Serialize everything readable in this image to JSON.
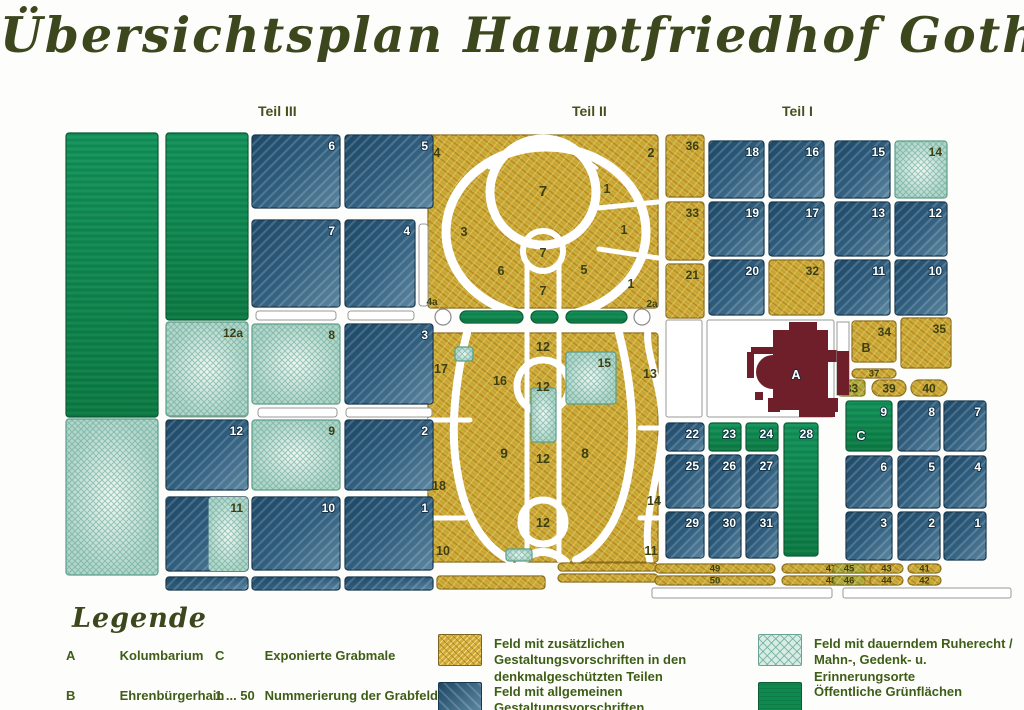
{
  "title": "Übersichtsplan Hauptfriedhof Gotha",
  "sections": [
    {
      "label": "Teil III"
    },
    {
      "label": "Teil II"
    },
    {
      "label": "Teil I"
    }
  ],
  "colors": {
    "gold": "#d3ac37",
    "blue": "#2e5a7b",
    "teal": "#cde7df",
    "green": "#0f8a4e",
    "building": "#6e1f2a",
    "text_olive": "#3e5d16"
  },
  "map": {
    "building_label": "A",
    "panels": [
      {
        "x": 428,
        "y": 135,
        "w": 230,
        "h": 173,
        "c": "gold"
      },
      {
        "x": 428,
        "y": 333,
        "w": 230,
        "h": 229,
        "c": "gold"
      }
    ],
    "fields": [
      {
        "x": 66,
        "y": 133,
        "w": 92,
        "h": 284,
        "c": "green"
      },
      {
        "x": 66,
        "y": 419,
        "w": 92,
        "h": 156,
        "c": "teal"
      },
      {
        "x": 166,
        "y": 133,
        "w": 82,
        "h": 187,
        "c": "green"
      },
      {
        "label": "12a",
        "x": 166,
        "y": 322,
        "w": 82,
        "h": 94,
        "c": "teal"
      },
      {
        "label": "12",
        "x": 166,
        "y": 420,
        "w": 82,
        "h": 70,
        "c": "blue"
      },
      {
        "label": "11",
        "x": 166,
        "y": 497,
        "w": 82,
        "h": 74,
        "c": "split"
      },
      {
        "x": 166,
        "y": 577,
        "w": 82,
        "h": 13,
        "c": "blue"
      },
      {
        "label": "6",
        "x": 252,
        "y": 135,
        "w": 88,
        "h": 73,
        "c": "blue"
      },
      {
        "label": "7",
        "x": 252,
        "y": 220,
        "w": 88,
        "h": 87,
        "c": "blue"
      },
      {
        "label": "8",
        "x": 252,
        "y": 324,
        "w": 88,
        "h": 80,
        "c": "teal"
      },
      {
        "label": "9",
        "x": 252,
        "y": 420,
        "w": 88,
        "h": 70,
        "c": "teal"
      },
      {
        "label": "10",
        "x": 252,
        "y": 497,
        "w": 88,
        "h": 73,
        "c": "blue"
      },
      {
        "x": 252,
        "y": 577,
        "w": 88,
        "h": 13,
        "c": "blue"
      },
      {
        "label": "5",
        "x": 345,
        "y": 135,
        "w": 88,
        "h": 73,
        "c": "blue"
      },
      {
        "label": "4",
        "x": 345,
        "y": 220,
        "w": 70,
        "h": 87,
        "c": "blue"
      },
      {
        "label": "3",
        "x": 345,
        "y": 324,
        "w": 88,
        "h": 80,
        "c": "blue"
      },
      {
        "label": "2",
        "x": 345,
        "y": 420,
        "w": 88,
        "h": 70,
        "c": "blue"
      },
      {
        "label": "1",
        "x": 345,
        "y": 497,
        "w": 88,
        "h": 73,
        "c": "blue"
      },
      {
        "x": 345,
        "y": 577,
        "w": 88,
        "h": 13,
        "c": "blue"
      },
      {
        "label": "15",
        "x": 566,
        "y": 352,
        "w": 50,
        "h": 52,
        "c": "teal"
      },
      {
        "x": 531,
        "y": 388,
        "w": 25,
        "h": 54,
        "c": "teal"
      },
      {
        "x": 455,
        "y": 347,
        "w": 18,
        "h": 14,
        "c": "teal"
      },
      {
        "x": 506,
        "y": 549,
        "w": 26,
        "h": 12,
        "c": "teal"
      },
      {
        "x": 460,
        "y": 311,
        "w": 63,
        "h": 12,
        "c": "green",
        "s": "pill"
      },
      {
        "x": 531,
        "y": 311,
        "w": 27,
        "h": 12,
        "c": "green",
        "s": "pill"
      },
      {
        "x": 566,
        "y": 311,
        "w": 61,
        "h": 12,
        "c": "green",
        "s": "pill"
      },
      {
        "x": 443,
        "y": 317,
        "w": 8,
        "c": "white",
        "s": "circle"
      },
      {
        "x": 642,
        "y": 317,
        "w": 8,
        "c": "white",
        "s": "circle"
      },
      {
        "x": 437,
        "y": 576,
        "w": 108,
        "h": 13,
        "c": "gold"
      },
      {
        "x": 558,
        "y": 563,
        "w": 100,
        "h": 8,
        "c": "gold",
        "s": "pill"
      },
      {
        "x": 558,
        "y": 574,
        "w": 100,
        "h": 8,
        "c": "gold",
        "s": "pill"
      },
      {
        "label": "36",
        "x": 666,
        "y": 135,
        "w": 38,
        "h": 62,
        "c": "gold"
      },
      {
        "label": "33",
        "x": 666,
        "y": 202,
        "w": 38,
        "h": 58,
        "c": "gold"
      },
      {
        "label": "21",
        "x": 666,
        "y": 264,
        "w": 38,
        "h": 54,
        "c": "gold"
      },
      {
        "label": "18",
        "x": 709,
        "y": 141,
        "w": 55,
        "h": 57,
        "c": "blue"
      },
      {
        "label": "16",
        "x": 769,
        "y": 141,
        "w": 55,
        "h": 57,
        "c": "blue"
      },
      {
        "label": "19",
        "x": 709,
        "y": 202,
        "w": 55,
        "h": 54,
        "c": "blue"
      },
      {
        "label": "17",
        "x": 769,
        "y": 202,
        "w": 55,
        "h": 54,
        "c": "blue"
      },
      {
        "label": "20",
        "x": 709,
        "y": 260,
        "w": 55,
        "h": 55,
        "c": "blue"
      },
      {
        "label": "32",
        "x": 769,
        "y": 260,
        "w": 55,
        "h": 55,
        "c": "gold"
      },
      {
        "label": "15",
        "x": 835,
        "y": 141,
        "w": 55,
        "h": 57,
        "c": "blue"
      },
      {
        "label": "14",
        "x": 895,
        "y": 141,
        "w": 52,
        "h": 57,
        "c": "teal"
      },
      {
        "label": "13",
        "x": 835,
        "y": 202,
        "w": 55,
        "h": 54,
        "c": "blue"
      },
      {
        "label": "12",
        "x": 895,
        "y": 202,
        "w": 52,
        "h": 54,
        "c": "blue"
      },
      {
        "label": "11",
        "x": 835,
        "y": 260,
        "w": 55,
        "h": 55,
        "c": "blue"
      },
      {
        "label": "10",
        "x": 895,
        "y": 260,
        "w": 52,
        "h": 55,
        "c": "blue"
      },
      {
        "label": "34",
        "x": 852,
        "y": 321,
        "w": 44,
        "h": 41,
        "c": "gold"
      },
      {
        "label": "35",
        "x": 901,
        "y": 318,
        "w": 50,
        "h": 50,
        "c": "gold"
      },
      {
        "label": "37",
        "x": 852,
        "y": 369,
        "w": 44,
        "h": 9,
        "c": "gold",
        "s": "pill",
        "lp": "c"
      },
      {
        "label": "33",
        "x": 838,
        "y": 380,
        "w": 27,
        "h": 16,
        "c": "goldgreen",
        "lp": "c"
      },
      {
        "label": "39",
        "x": 872,
        "y": 380,
        "w": 34,
        "h": 16,
        "c": "gold",
        "s": "pill",
        "lp": "c"
      },
      {
        "label": "40",
        "x": 911,
        "y": 380,
        "w": 36,
        "h": 16,
        "c": "gold",
        "s": "pill",
        "lp": "c"
      },
      {
        "label": "9",
        "x": 846,
        "y": 401,
        "w": 46,
        "h": 50,
        "c": "green"
      },
      {
        "label": "8",
        "x": 898,
        "y": 401,
        "w": 42,
        "h": 50,
        "c": "blue"
      },
      {
        "label": "7",
        "x": 944,
        "y": 401,
        "w": 42,
        "h": 50,
        "c": "blue"
      },
      {
        "label": "6",
        "x": 846,
        "y": 456,
        "w": 46,
        "h": 52,
        "c": "blue"
      },
      {
        "label": "5",
        "x": 898,
        "y": 456,
        "w": 42,
        "h": 52,
        "c": "blue"
      },
      {
        "label": "4",
        "x": 944,
        "y": 456,
        "w": 42,
        "h": 52,
        "c": "blue"
      },
      {
        "label": "3",
        "x": 846,
        "y": 512,
        "w": 46,
        "h": 48,
        "c": "blue"
      },
      {
        "label": "2",
        "x": 898,
        "y": 512,
        "w": 42,
        "h": 48,
        "c": "blue"
      },
      {
        "label": "1",
        "x": 944,
        "y": 512,
        "w": 42,
        "h": 48,
        "c": "blue"
      },
      {
        "label": "22",
        "x": 666,
        "y": 423,
        "w": 38,
        "h": 28,
        "c": "blue"
      },
      {
        "label": "23",
        "x": 709,
        "y": 423,
        "w": 32,
        "h": 28,
        "c": "green"
      },
      {
        "label": "24",
        "x": 746,
        "y": 423,
        "w": 32,
        "h": 28,
        "c": "green"
      },
      {
        "label": "28",
        "x": 784,
        "y": 423,
        "w": 34,
        "h": 133,
        "c": "green"
      },
      {
        "label": "25",
        "x": 666,
        "y": 455,
        "w": 38,
        "h": 53,
        "c": "blue"
      },
      {
        "label": "26",
        "x": 709,
        "y": 455,
        "w": 32,
        "h": 53,
        "c": "blue"
      },
      {
        "label": "27",
        "x": 746,
        "y": 455,
        "w": 32,
        "h": 53,
        "c": "blue"
      },
      {
        "label": "29",
        "x": 666,
        "y": 512,
        "w": 38,
        "h": 46,
        "c": "blue"
      },
      {
        "label": "30",
        "x": 709,
        "y": 512,
        "w": 32,
        "h": 46,
        "c": "blue"
      },
      {
        "label": "31",
        "x": 746,
        "y": 512,
        "w": 32,
        "h": 46,
        "c": "blue"
      },
      {
        "label": "49",
        "x": 655,
        "y": 564,
        "w": 120,
        "h": 9,
        "c": "gold",
        "s": "pill",
        "lp": "c"
      },
      {
        "label": "47",
        "x": 782,
        "y": 564,
        "w": 98,
        "h": 9,
        "c": "gold",
        "s": "pill",
        "lp": "c"
      },
      {
        "label": "50",
        "x": 655,
        "y": 576,
        "w": 120,
        "h": 9,
        "c": "gold",
        "s": "pill",
        "lp": "c"
      },
      {
        "label": "48",
        "x": 782,
        "y": 576,
        "w": 98,
        "h": 9,
        "c": "gold",
        "s": "pill",
        "lp": "c"
      },
      {
        "label": "45",
        "x": 833,
        "y": 564,
        "w": 32,
        "h": 9,
        "c": "goldgreen",
        "s": "pill",
        "lp": "c"
      },
      {
        "label": "43",
        "x": 870,
        "y": 564,
        "w": 33,
        "h": 9,
        "c": "gold",
        "s": "pill",
        "lp": "c"
      },
      {
        "label": "41",
        "x": 908,
        "y": 564,
        "w": 33,
        "h": 9,
        "c": "gold",
        "s": "pill",
        "lp": "c"
      },
      {
        "label": "46",
        "x": 833,
        "y": 576,
        "w": 32,
        "h": 9,
        "c": "goldgreen",
        "s": "pill",
        "lp": "c"
      },
      {
        "label": "44",
        "x": 870,
        "y": 576,
        "w": 33,
        "h": 9,
        "c": "gold",
        "s": "pill",
        "lp": "c"
      },
      {
        "label": "42",
        "x": 908,
        "y": 576,
        "w": 33,
        "h": 9,
        "c": "gold",
        "s": "pill",
        "lp": "c"
      }
    ],
    "labels": [
      {
        "t": "4",
        "x": 437,
        "y": 157
      },
      {
        "t": "2",
        "x": 651,
        "y": 157
      },
      {
        "t": "7",
        "x": 543,
        "y": 196,
        "fs": 15
      },
      {
        "t": "1",
        "x": 607,
        "y": 193
      },
      {
        "t": "3",
        "x": 464,
        "y": 236
      },
      {
        "t": "1",
        "x": 624,
        "y": 234
      },
      {
        "t": "7",
        "x": 543,
        "y": 257
      },
      {
        "t": "6",
        "x": 501,
        "y": 275
      },
      {
        "t": "5",
        "x": 584,
        "y": 274
      },
      {
        "t": "1",
        "x": 631,
        "y": 288
      },
      {
        "t": "7",
        "x": 543,
        "y": 295
      },
      {
        "t": "4a",
        "x": 432,
        "y": 305,
        "fs": 10
      },
      {
        "t": "2a",
        "x": 652,
        "y": 307,
        "fs": 10
      },
      {
        "t": "12",
        "x": 543,
        "y": 351
      },
      {
        "t": "17",
        "x": 441,
        "y": 373
      },
      {
        "t": "16",
        "x": 500,
        "y": 385
      },
      {
        "t": "12",
        "x": 543,
        "y": 391
      },
      {
        "t": "13",
        "x": 650,
        "y": 378
      },
      {
        "t": "9",
        "x": 504,
        "y": 458,
        "fs": 14
      },
      {
        "t": "8",
        "x": 585,
        "y": 458,
        "fs": 14
      },
      {
        "t": "18",
        "x": 439,
        "y": 490
      },
      {
        "t": "12",
        "x": 543,
        "y": 463
      },
      {
        "t": "12",
        "x": 543,
        "y": 527
      },
      {
        "t": "14",
        "x": 654,
        "y": 505
      },
      {
        "t": "10",
        "x": 443,
        "y": 555
      },
      {
        "t": "11",
        "x": 651,
        "y": 555
      },
      {
        "t": "B",
        "x": 866,
        "y": 352
      },
      {
        "t": "A",
        "x": 796,
        "y": 379,
        "c": "light"
      },
      {
        "t": "C",
        "x": 861,
        "y": 440,
        "c": "light"
      }
    ]
  },
  "legend": {
    "heading": "Legende",
    "abbreviations": [
      {
        "key": "A",
        "label": "Kolumbarium"
      },
      {
        "key": "B",
        "label": "Ehrenbürgerhain"
      },
      {
        "key": "C",
        "label": "Exponierte Grabmale"
      },
      {
        "key": "1 ... 50",
        "label": "Nummerierung der Grabfelder"
      }
    ],
    "swatches": [
      {
        "type": "gold",
        "label": "Feld mit zusätzlichen Gestaltungsvorschriften in den denkmalgeschützten Teilen"
      },
      {
        "type": "blue",
        "label": "Feld mit allgemeinen Gestaltungsvorschriften"
      },
      {
        "type": "teal",
        "label": "Feld mit dauerndem Ruherecht / Mahn-, Gedenk- u. Erinnerungsorte"
      },
      {
        "type": "green",
        "label": "Öffentliche Grünflächen"
      }
    ]
  }
}
